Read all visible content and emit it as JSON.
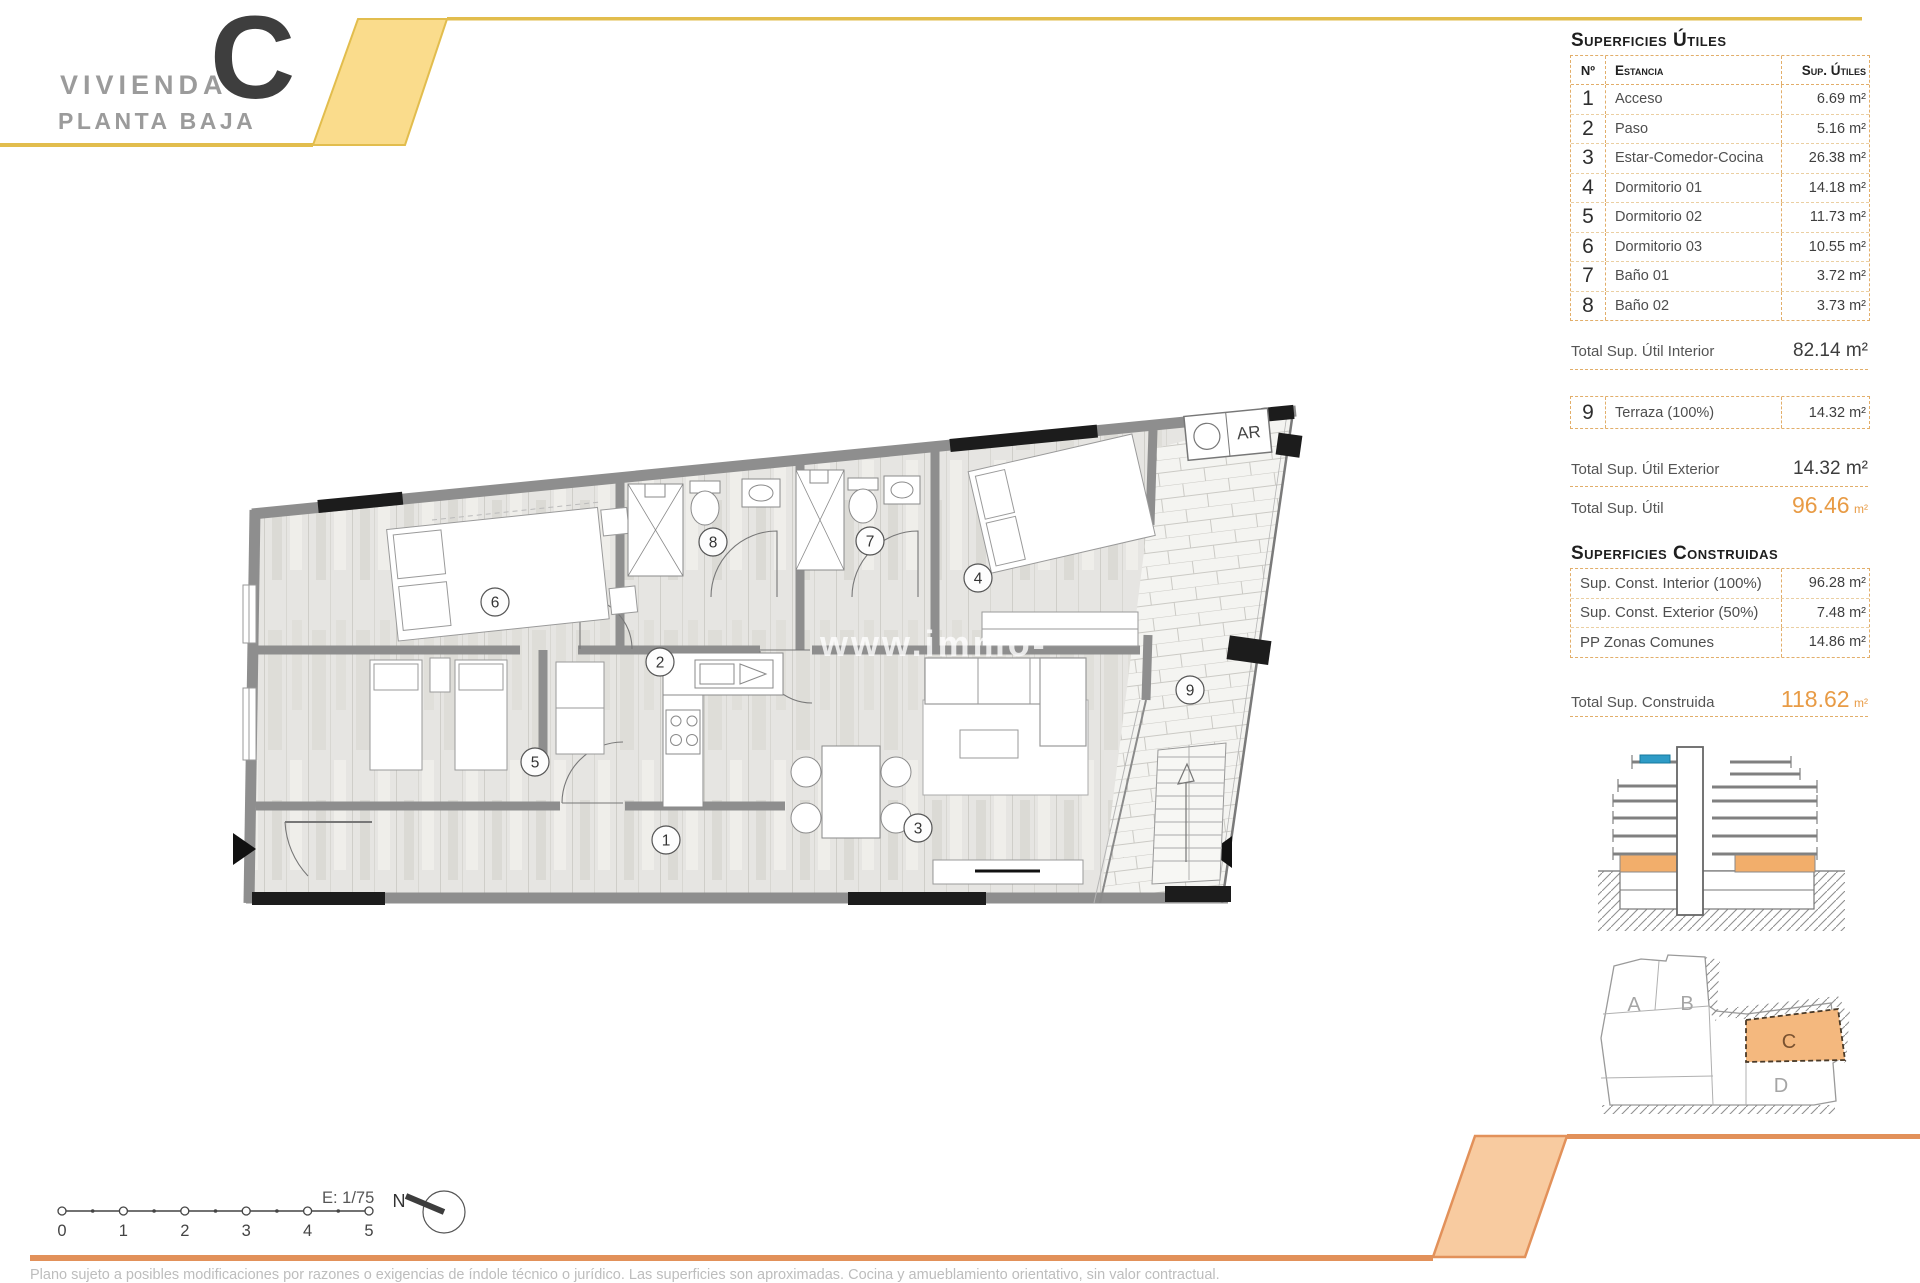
{
  "header": {
    "title_line1": "VIVIENDA",
    "title_line2": "PLANTA BAJA",
    "unit_letter": "C"
  },
  "useful_table": {
    "title": "Superficies Útiles",
    "col_num": "Nº",
    "col_room": "Estancia",
    "col_area": "Sup. Útiles",
    "rows": [
      {
        "n": "1",
        "name": "Acceso",
        "area": "6.69 m²"
      },
      {
        "n": "2",
        "name": "Paso",
        "area": "5.16 m²"
      },
      {
        "n": "3",
        "name": "Estar-Comedor-Cocina",
        "area": "26.38 m²"
      },
      {
        "n": "4",
        "name": "Dormitorio 01",
        "area": "14.18 m²"
      },
      {
        "n": "5",
        "name": "Dormitorio 02",
        "area": "11.73 m²"
      },
      {
        "n": "6",
        "name": "Dormitorio 03",
        "area": "10.55 m²"
      },
      {
        "n": "7",
        "name": "Baño 01",
        "area": "3.72 m²"
      },
      {
        "n": "8",
        "name": "Baño 02",
        "area": "3.73 m²"
      }
    ],
    "total_interior_label": "Total Sup. Útil Interior",
    "total_interior_value": "82.14 m²",
    "terrace_row": {
      "n": "9",
      "name": "Terraza (100%)",
      "area": "14.32 m²"
    },
    "total_exterior_label": "Total Sup. Útil Exterior",
    "total_exterior_value": "14.32 m²",
    "total_label": "Total Sup. Útil",
    "total_value": "96.46",
    "total_unit": "m²"
  },
  "built_table": {
    "title": "Superficies Construidas",
    "rows": [
      {
        "name": "Sup. Const. Interior (100%)",
        "area": "96.28 m²"
      },
      {
        "name": "Sup. Const. Exterior (50%)",
        "area": "7.48 m²"
      },
      {
        "name": "PP Zonas Comunes",
        "area": "14.86 m²"
      }
    ],
    "total_label": "Total Sup. Construida",
    "total_value": "118.62",
    "total_unit": "m²"
  },
  "plan": {
    "room_labels": [
      "1",
      "2",
      "3",
      "4",
      "5",
      "6",
      "7",
      "8",
      "9"
    ],
    "ar_label": "AR",
    "watermark": "www.immo-"
  },
  "scalebar": {
    "scale_label": "E: 1/75",
    "ticks": [
      "0",
      "1",
      "2",
      "3",
      "4",
      "5"
    ],
    "north_label": "N"
  },
  "site_plan": {
    "unit_a": "A",
    "unit_b": "B",
    "unit_c": "C",
    "unit_d": "D"
  },
  "footer": {
    "disclaimer": "Plano sujeto a posibles modificaciones por razones o exigencias de índole técnico o jurídico. Las superficies son aproximadas. Cocina y amueblamiento orientativo, sin valor contractual."
  },
  "colors": {
    "gold": "#E2BD4D",
    "gold_fill": "#FADC8C",
    "orange": "#E2915A",
    "orange_fill": "#F8CBA0",
    "accent": "#E89B45"
  }
}
